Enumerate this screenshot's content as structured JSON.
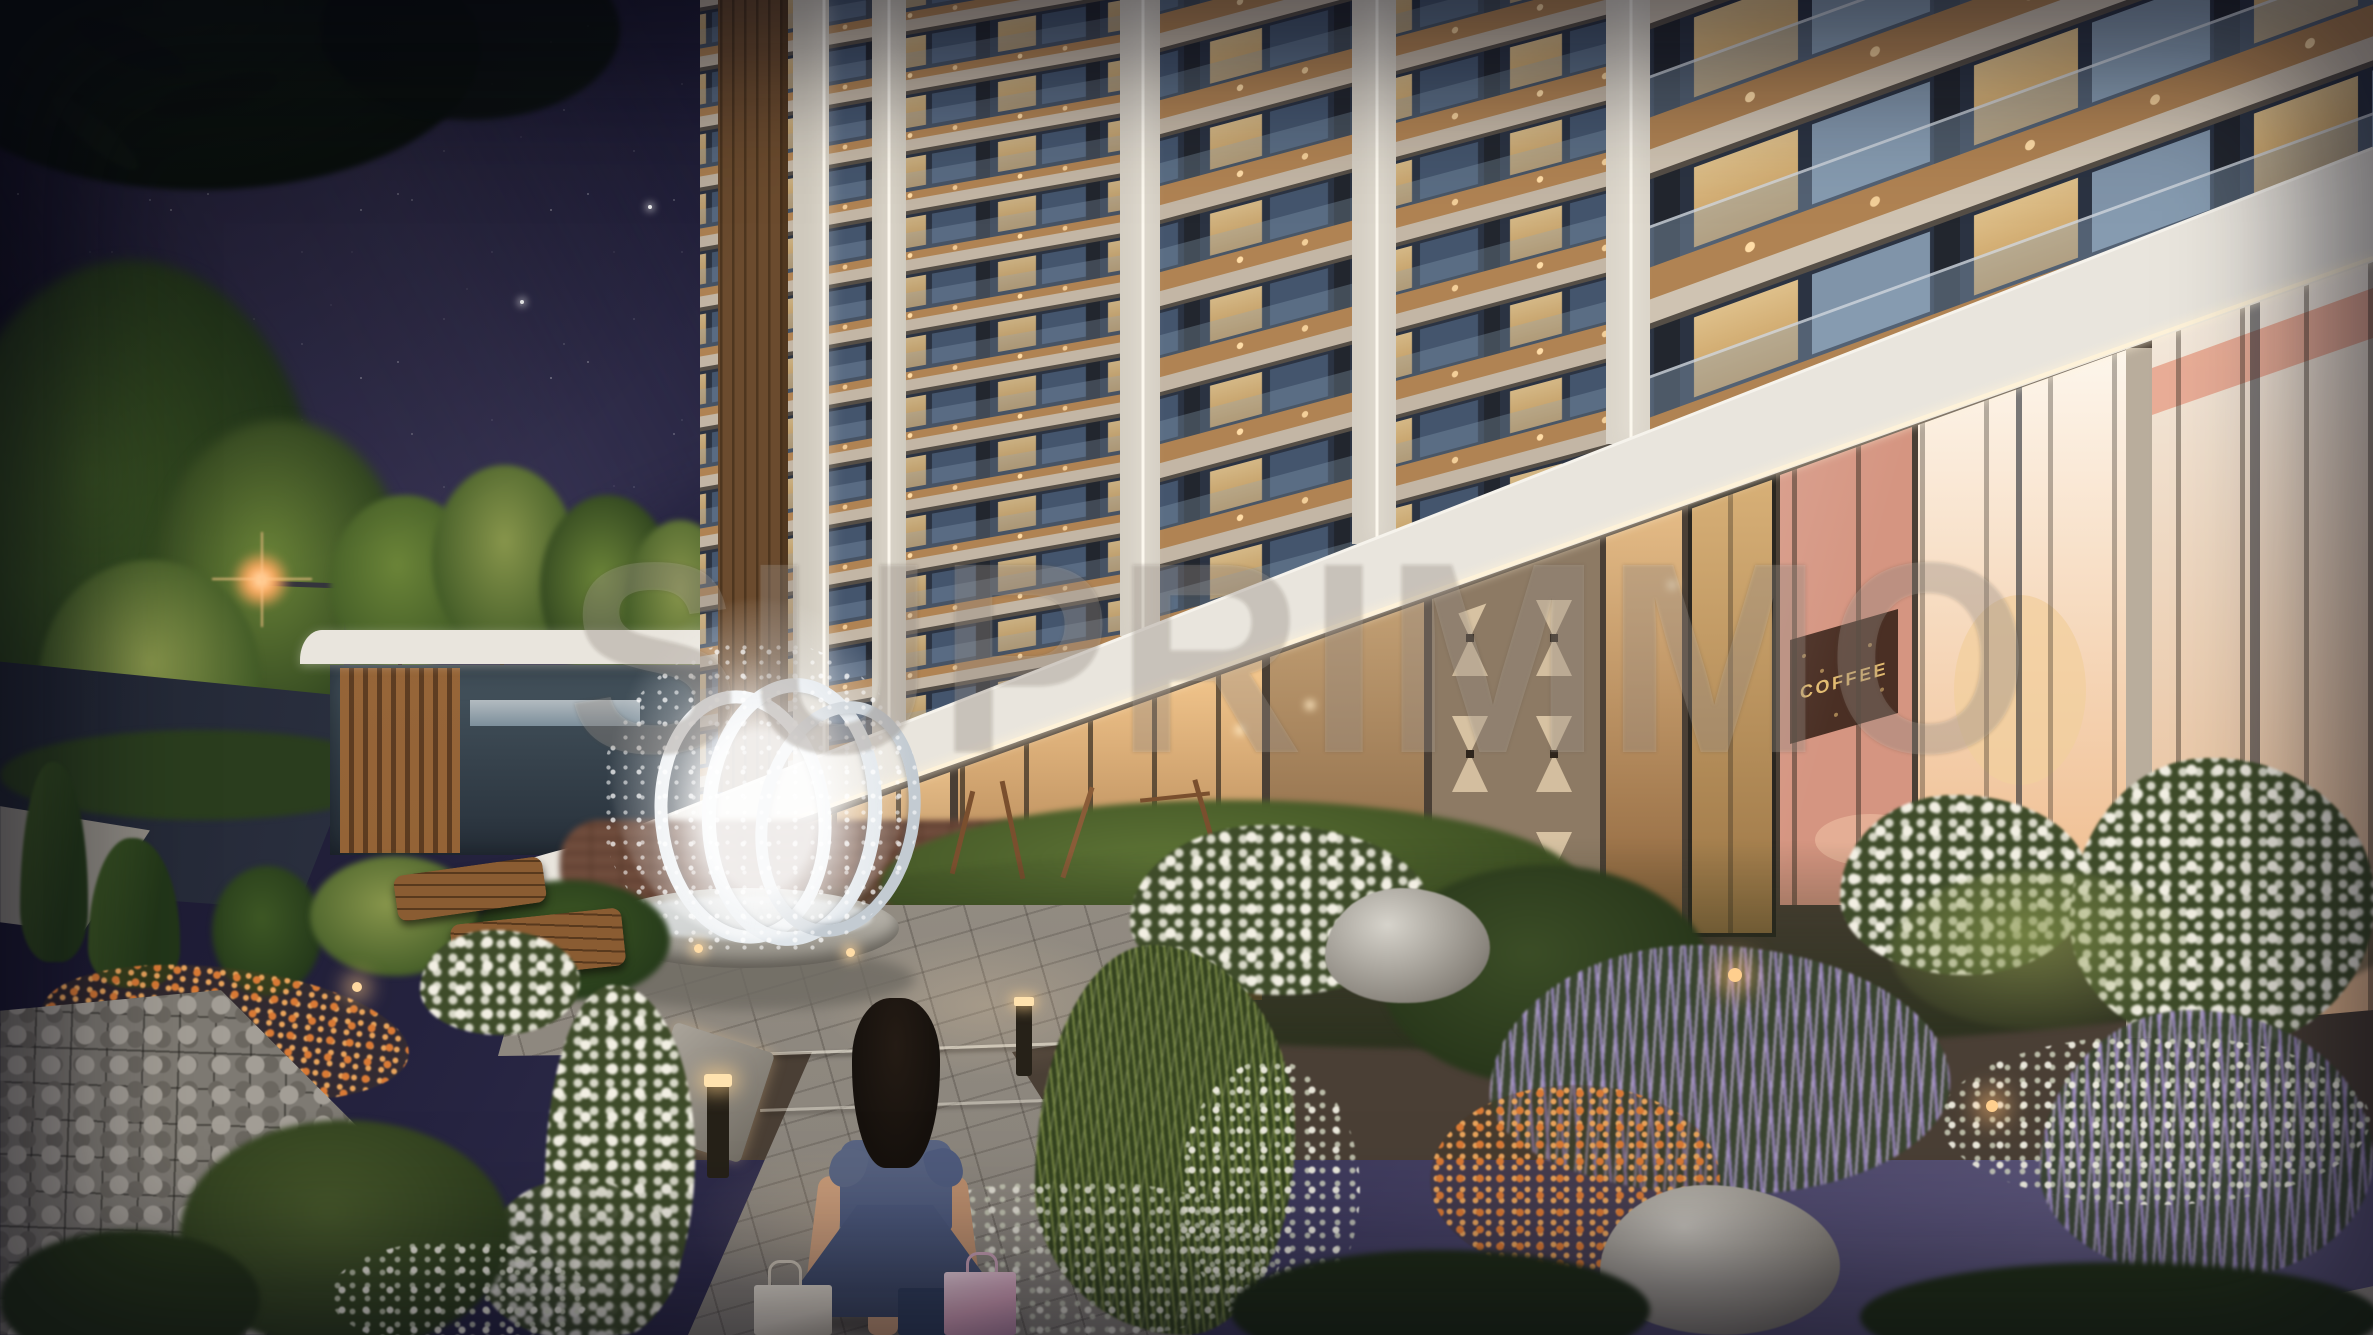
{
  "scene": {
    "width": 2373,
    "height": 1335
  },
  "watermark": {
    "text": "SUPRIMMO"
  },
  "signs": {
    "coffee_wall_art": "COFFEE"
  },
  "fountain": {
    "ring_count": 3
  },
  "palette": {
    "sky1": "#121022",
    "sky2": "#262441",
    "sky3": "#3e3a5c",
    "sky4": "#5a5478",
    "star": "#ffffff",
    "haze": "#8278aa",
    "branch": "#0b120c",
    "treedark": "#223619",
    "treemid": "#3d5724",
    "treelight": "#6b8438",
    "treelit": "#87954b",
    "trunk": "#2c2015",
    "lampglow": "#ffa95e",
    "lamppole": "#34343c",
    "road": "#202531",
    "sidewalk": "#8e8a82",
    "hedge": "#2a3d1e",
    "pavroof": "#e9e5dd",
    "pavglass": "#46555f",
    "pavwood": "#9a6636",
    "cream": "#c3b6a5",
    "creamlt": "#cfc3b2",
    "slabshadow": "#554e46",
    "windark": "#2b3342",
    "winlit": "#f2cf92",
    "winlitdeep": "#d9a860",
    "windim": "#44556d",
    "glassblue": "#8fa5bb",
    "soffit": "#b08353",
    "downlight": "#ffdca6",
    "led": "#fcf8ee",
    "canopy": "#e9e5dd",
    "canopyled": "#fff3d9",
    "podium": "#4a3f35",
    "storeglow1": "#f6c98f",
    "storeglow2": "#8e6238",
    "entrwall": "#8d7a64",
    "sconce": "#f4dfba",
    "door1": "#d8b077",
    "door2": "#9a7444",
    "salmon": "#d59581",
    "coffeepanel": "#4a2f24",
    "gold": "#e2bb71",
    "brightin1": "#fdf6ec",
    "brightin2": "#f0bf92",
    "ceilpink": "#e8a38c",
    "mullion": "#32291f",
    "framedark": "#22262e",
    "lawn1": "#5d7335",
    "lawn2": "#37491f",
    "hydrbase": "#3f4c2a",
    "hydrdot": "#f2efe3",
    "hydrdot2": "#d8d8c8",
    "salvbase": "#3a4631",
    "salv1": "#a08cc8",
    "salv2": "#c3b2dc",
    "grassy": "#7c8c46",
    "orange": "#d97a35",
    "pathlight": "#9a948b",
    "pathjoint": "#56514b",
    "pathwarm": "#ffdcae",
    "stone1": "#c6c2ba",
    "stone2": "#8b867e",
    "stone3": "#5f5b54",
    "gabion": "#7e7a73",
    "gabdark": "#3a3833",
    "bench": "#8a5c32",
    "brick": "#6f4c3c",
    "playwood": "#7a4f2e",
    "ringlt": "#e9edf0",
    "ringdk": "#c3cbd2",
    "basin1": "#c9c5bc",
    "basin2": "#8f8b82",
    "hair": "#16110d",
    "dress1": "#5a6582",
    "dress2": "#3f4a66",
    "skin": "#c89b79",
    "bagwhite": "#ded6c8",
    "bagpink": "#dca6be",
    "bagnavy": "#33415f",
    "bollard": "#262118",
    "bolllight": "#ffe2ae"
  }
}
